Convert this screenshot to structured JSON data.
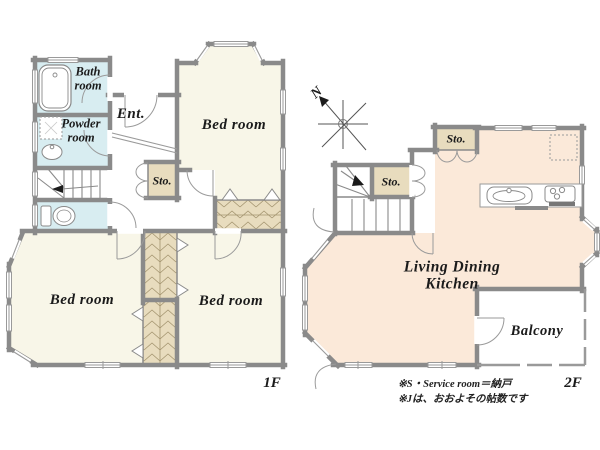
{
  "floor_1": {
    "floor_label": "1F",
    "rooms": {
      "bath": "Bath room",
      "powder": "Powder room",
      "entrance": "Ent.",
      "bedroom_top": "Bed room",
      "bedroom_left": "Bed room",
      "bedroom_right": "Bed room",
      "storage": "Sto."
    }
  },
  "floor_2": {
    "floor_label": "2F",
    "rooms": {
      "storage_by_stairs": "Sto.",
      "storage_top": "Sto.",
      "ldk": "Living Dining Kitchen",
      "balcony": "Balcony"
    }
  },
  "compass_north": "N",
  "notes": [
    "※S・Service room＝納戸",
    "※Jは、おおよその帖数です"
  ],
  "colors": {
    "wall": "#8a8a8a",
    "bedroom_fill": "#f8f6e8",
    "ldk_fill": "#fbe9d9",
    "wet_room_fill": "#d8edf1",
    "storage_fill": "#e8dcbe",
    "hatch_line": "#a3946f"
  }
}
